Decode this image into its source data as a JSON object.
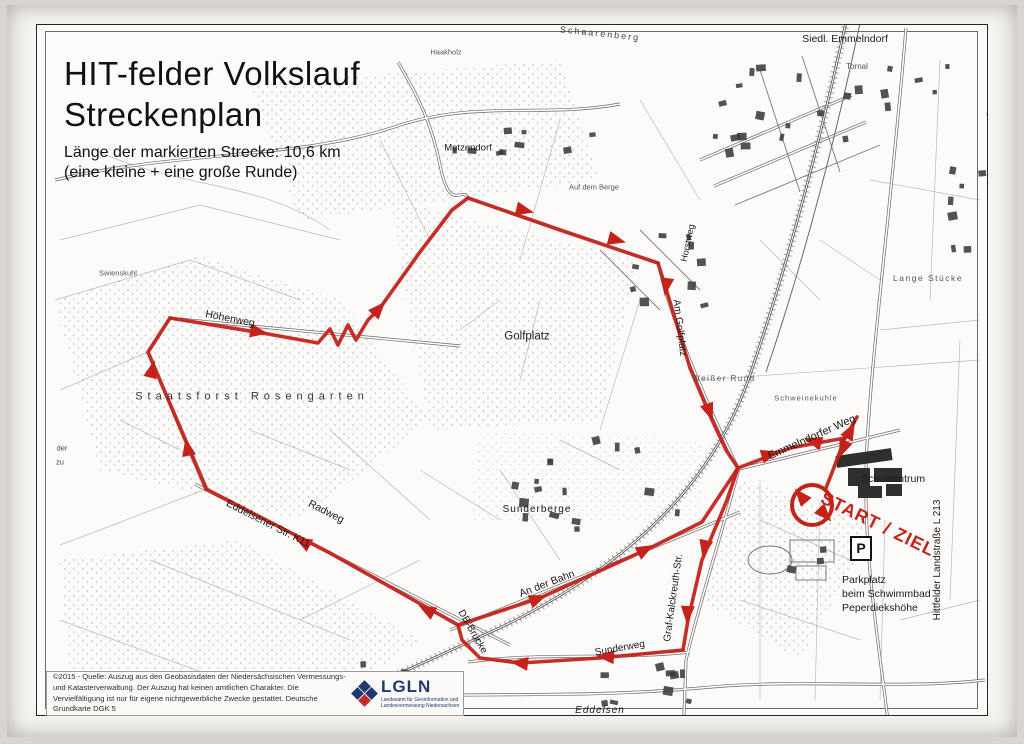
{
  "page": {
    "title1": "HIT-felder Volkslauf",
    "title2": "Streckenplan",
    "subtitle1": "Länge der markierten Strecke: 10,6 km",
    "subtitle2": "(eine kleine + eine große Runde)"
  },
  "footer": {
    "copyright": "©2015 - Quelle: Auszug aus den Geobasisdaten der Niedersächsischen Vermessungs- und Katasterverwaltung. Der Auszug hat keinen amtlichen Charakter. Die Vervielfältigung ist nur für eigene nichtgewerbliche Zwecke gestattet. Deutsche Grundkarte DGK 5",
    "logo_word": "LGLN",
    "logo_sub": "Landesamt für Geoinformation und Landesvermessung Niedersachsen",
    "logo_navy": "#1d3a6e",
    "logo_red": "#c42b2b"
  },
  "map": {
    "parking_symbol": "P",
    "route": {
      "color": "#c3231b",
      "loop": {
        "cx": 812,
        "cy": 505,
        "r": 20
      },
      "paths": [
        {
          "name": "route-top-path",
          "points": [
            [
              468,
              198
            ],
            [
              560,
              230
            ],
            [
              658,
              263
            ]
          ]
        },
        {
          "name": "route-am-golfplatz",
          "points": [
            [
              658,
              263
            ],
            [
              667,
              292
            ],
            [
              690,
              368
            ],
            [
              712,
              420
            ],
            [
              726,
              450
            ],
            [
              738,
              468
            ]
          ]
        },
        {
          "name": "route-emmelndorfer-weg",
          "points": [
            [
              738,
              468
            ],
            [
              790,
              448
            ],
            [
              845,
              438
            ],
            [
              857,
              417
            ]
          ]
        },
        {
          "name": "route-start-spur",
          "points": [
            [
              845,
              438
            ],
            [
              833,
              470
            ],
            [
              826,
              488
            ]
          ]
        },
        {
          "name": "route-graf-kalckreuth",
          "points": [
            [
              738,
              468
            ],
            [
              727,
              500
            ],
            [
              702,
              560
            ],
            [
              688,
              620
            ],
            [
              683,
              650
            ]
          ]
        },
        {
          "name": "route-sunderweg",
          "points": [
            [
              683,
              650
            ],
            [
              600,
              658
            ],
            [
              520,
              663
            ],
            [
              480,
              658
            ],
            [
              462,
              640
            ],
            [
              458,
              625
            ]
          ]
        },
        {
          "name": "route-eddelsener-str",
          "points": [
            [
              458,
              625
            ],
            [
              330,
              553
            ],
            [
              206,
              489
            ]
          ]
        },
        {
          "name": "route-forest-climb",
          "points": [
            [
              206,
              489
            ],
            [
              148,
              352
            ],
            [
              170,
              318
            ]
          ]
        },
        {
          "name": "route-hoehenweg-golf",
          "points": [
            [
              170,
              318
            ],
            [
              268,
              334
            ],
            [
              318,
              343
            ],
            [
              330,
              329
            ],
            [
              338,
              345
            ],
            [
              348,
              325
            ],
            [
              356,
              340
            ],
            [
              368,
              320
            ],
            [
              380,
              308
            ],
            [
              420,
              252
            ],
            [
              452,
              210
            ],
            [
              468,
              198
            ]
          ]
        },
        {
          "name": "route-an-der-bahn",
          "points": [
            [
              458,
              625
            ],
            [
              540,
              598
            ],
            [
              650,
              548
            ],
            [
              702,
              522
            ],
            [
              738,
              468
            ]
          ]
        }
      ],
      "arrows": [
        [
          532,
          212,
          13
        ],
        [
          624,
          242,
          15
        ],
        [
          665,
          294,
          98
        ],
        [
          712,
          419,
          70
        ],
        [
          777,
          452,
          -17
        ],
        [
          806,
          439,
          197
        ],
        [
          854,
          424,
          -62
        ],
        [
          840,
          456,
          112
        ],
        [
          703,
          556,
          102
        ],
        [
          687,
          622,
          93
        ],
        [
          598,
          656,
          184
        ],
        [
          512,
          662,
          187
        ],
        [
          420,
          606,
          -151
        ],
        [
          296,
          538,
          -151
        ],
        [
          186,
          440,
          -101
        ],
        [
          154,
          362,
          -76
        ],
        [
          266,
          333,
          9
        ],
        [
          384,
          303,
          -48
        ],
        [
          545,
          596,
          -21
        ],
        [
          652,
          546,
          -28
        ],
        [
          796,
          490,
          -130
        ],
        [
          830,
          520,
          47
        ]
      ]
    },
    "labels": [
      {
        "t": "Siedl. Emmelndorf",
        "x": 845,
        "y": 39,
        "s": 10.5
      },
      {
        "t": "Tornal",
        "x": 857,
        "y": 67,
        "s": 8,
        "c": "#555"
      },
      {
        "t": "Schaarenberg",
        "x": 600,
        "y": 34,
        "s": 9,
        "r": 6,
        "sp": 2,
        "c": "#444"
      },
      {
        "t": "Metzendorf",
        "x": 468,
        "y": 148,
        "s": 9.5
      },
      {
        "t": "Haakholz",
        "x": 446,
        "y": 52,
        "s": 7.5,
        "c": "#555"
      },
      {
        "t": "Höhenweg",
        "x": 230,
        "y": 319,
        "s": 10.5,
        "r": 11
      },
      {
        "t": "Golfplatz",
        "x": 527,
        "y": 337,
        "s": 11.5
      },
      {
        "t": "Staatsforst Rosengarten",
        "x": 252,
        "y": 397,
        "s": 11,
        "sp": 5,
        "c": "#333"
      },
      {
        "t": "Horstweg",
        "x": 688,
        "y": 243,
        "s": 9,
        "r": -78
      },
      {
        "t": "Am Golfplatz",
        "x": 679,
        "y": 328,
        "s": 10,
        "r": 83
      },
      {
        "t": "Weißer Rund",
        "x": 724,
        "y": 379,
        "s": 8,
        "sp": 1.5,
        "c": "#555"
      },
      {
        "t": "Emmelndorfer Weg",
        "x": 812,
        "y": 438,
        "s": 11,
        "r": -24
      },
      {
        "t": "Schweinekuhle",
        "x": 806,
        "y": 398,
        "s": 7.5,
        "sp": 1,
        "c": "#555"
      },
      {
        "t": "Schulzentrum",
        "x": 893,
        "y": 479,
        "s": 10.5
      },
      {
        "t": "START / ZIEL",
        "x": 878,
        "y": 524,
        "s": 18,
        "r": 26,
        "sp": 1,
        "c": "#c3231b",
        "w": 700
      },
      {
        "t": "Parkplatz",
        "x": 842,
        "y": 580,
        "s": 10.5,
        "a": "l"
      },
      {
        "t": "beim Schwimmbad",
        "x": 842,
        "y": 594,
        "s": 10.5,
        "a": "l"
      },
      {
        "t": "Peperdiekshöhe",
        "x": 842,
        "y": 608,
        "s": 10.5,
        "a": "l"
      },
      {
        "t": "Hittfelder Landstraße L 213",
        "x": 938,
        "y": 560,
        "s": 10,
        "r": -90
      },
      {
        "t": "Eddelsener Str. K11",
        "x": 268,
        "y": 524,
        "s": 10.5,
        "r": 27
      },
      {
        "t": "Radweg",
        "x": 326,
        "y": 512,
        "s": 10.5,
        "r": 27
      },
      {
        "t": "An der Bahn",
        "x": 547,
        "y": 584,
        "s": 10.5,
        "r": -21
      },
      {
        "t": "DB-Brücke",
        "x": 472,
        "y": 632,
        "s": 10,
        "r": 60
      },
      {
        "t": "Sunderweg",
        "x": 620,
        "y": 649,
        "s": 10,
        "r": -10
      },
      {
        "t": "Sunderberge",
        "x": 537,
        "y": 510,
        "s": 10,
        "sp": 1
      },
      {
        "t": "Graf-Kalckreuth-Str.",
        "x": 674,
        "y": 598,
        "s": 10,
        "r": -82
      },
      {
        "t": "Eddelsen",
        "x": 600,
        "y": 711,
        "s": 10,
        "sp": 1,
        "i": 1
      },
      {
        "t": "Lange Stücke",
        "x": 928,
        "y": 278,
        "s": 8.5,
        "sp": 1.5,
        "c": "#555"
      },
      {
        "t": "Swienskuhl",
        "x": 118,
        "y": 273,
        "s": 7.5,
        "c": "#555"
      },
      {
        "t": "Auf dem Berge",
        "x": 594,
        "y": 187,
        "s": 7.5,
        "c": "#555"
      },
      {
        "t": "der",
        "x": 62,
        "y": 448,
        "s": 7.5,
        "c": "#444"
      },
      {
        "t": "zu",
        "x": 60,
        "y": 462,
        "s": 7.5,
        "c": "#444"
      }
    ]
  }
}
